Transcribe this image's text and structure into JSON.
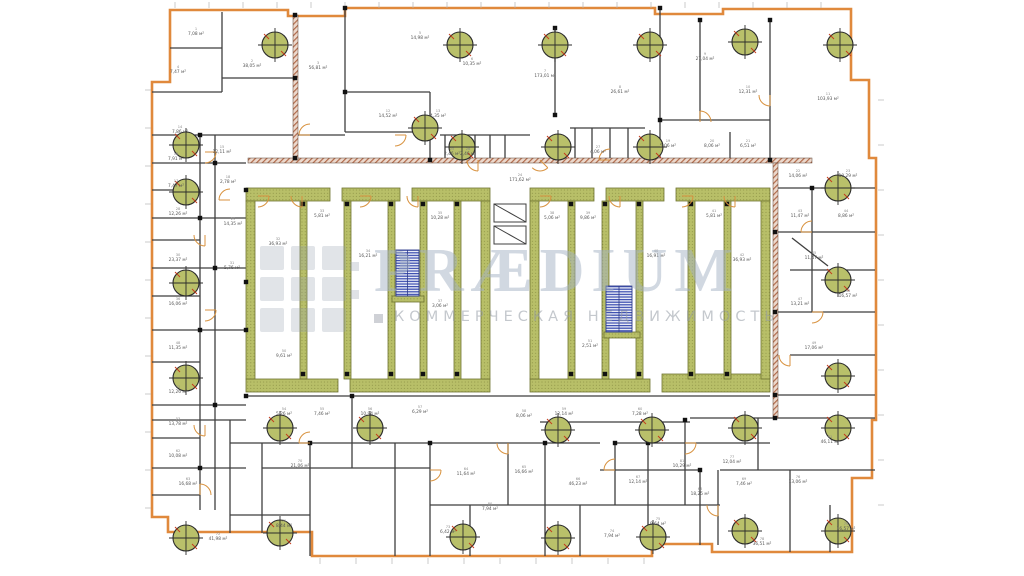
{
  "watermark": {
    "brand": "PRÆDIUM",
    "tagline": "КОММЕРЧЕСКАЯ НЕДВИЖИМОСТЬ"
  },
  "units": {
    "area": "м²"
  },
  "colors": {
    "exterior_wall": "#E0893C",
    "interior_wall": "#3F3F3F",
    "core_wall": "#B8BF68",
    "core_wall_edge": "#6F7430",
    "stair_hatch": "#3C4EB0",
    "column_marker": "#B9C06A",
    "door_arc": "#D8923F",
    "watermark_text": "#A8B2C4"
  },
  "symbols": {
    "column_marker": "circle-with-cross",
    "staircase": "navy-hatched-rect",
    "door": "quarter-arc",
    "brick_wall": "diagonal-hatch-band"
  },
  "rooms": [
    {
      "n": "1",
      "a": "7,08",
      "x": 196,
      "y": 30
    },
    {
      "n": "2",
      "a": "38,05",
      "x": 252,
      "y": 62
    },
    {
      "n": "3",
      "a": "56,81",
      "x": 318,
      "y": 64
    },
    {
      "n": "4",
      "a": "7,47",
      "x": 178,
      "y": 68
    },
    {
      "n": "5",
      "a": "14,98",
      "x": 420,
      "y": 34
    },
    {
      "n": "6",
      "a": "10,35",
      "x": 472,
      "y": 60
    },
    {
      "n": "7",
      "a": "173,01",
      "x": 545,
      "y": 72
    },
    {
      "n": "8",
      "a": "26,61",
      "x": 620,
      "y": 88
    },
    {
      "n": "9",
      "a": "27,04",
      "x": 705,
      "y": 55
    },
    {
      "n": "10",
      "a": "12,31",
      "x": 748,
      "y": 88
    },
    {
      "n": "11",
      "a": "103,93",
      "x": 828,
      "y": 95
    },
    {
      "n": "12",
      "a": "14,52",
      "x": 388,
      "y": 112
    },
    {
      "n": "13",
      "a": "4,35",
      "x": 438,
      "y": 112
    },
    {
      "n": "14",
      "a": "7,86",
      "x": 180,
      "y": 128
    },
    {
      "n": "15",
      "a": "12,11",
      "x": 222,
      "y": 148
    },
    {
      "n": "16",
      "a": "7,91",
      "x": 176,
      "y": 155
    },
    {
      "n": "17",
      "a": "7,47",
      "x": 176,
      "y": 182
    },
    {
      "n": "18",
      "a": "2,78",
      "x": 228,
      "y": 178
    },
    {
      "n": "19",
      "a": "5,06",
      "x": 668,
      "y": 142
    },
    {
      "n": "20",
      "a": "8,06",
      "x": 712,
      "y": 142
    },
    {
      "n": "21",
      "a": "6,51",
      "x": 748,
      "y": 142
    },
    {
      "n": "22",
      "a": "14,06",
      "x": 798,
      "y": 172
    },
    {
      "n": "23",
      "a": "10,29",
      "x": 848,
      "y": 172
    },
    {
      "n": "24",
      "a": "171,62",
      "x": 520,
      "y": 176
    },
    {
      "n": "25",
      "a": "2,46",
      "x": 452,
      "y": 150
    },
    {
      "n": "26",
      "a": "2,46",
      "x": 468,
      "y": 150
    },
    {
      "n": "27",
      "a": "4,06",
      "x": 598,
      "y": 148
    },
    {
      "n": "28",
      "a": "12,26",
      "x": 178,
      "y": 210
    },
    {
      "n": "29",
      "a": "14,35",
      "x": 233,
      "y": 220
    },
    {
      "n": "30",
      "a": "23,37",
      "x": 178,
      "y": 256
    },
    {
      "n": "31",
      "a": "5,76",
      "x": 232,
      "y": 264
    },
    {
      "n": "32",
      "a": "36,93",
      "x": 278,
      "y": 240
    },
    {
      "n": "33",
      "a": "5,81",
      "x": 322,
      "y": 212
    },
    {
      "n": "34",
      "a": "16,21",
      "x": 368,
      "y": 252
    },
    {
      "n": "35",
      "a": "10,28",
      "x": 440,
      "y": 214
    },
    {
      "n": "36",
      "a": "16,06",
      "x": 178,
      "y": 300
    },
    {
      "n": "37",
      "a": "3,06",
      "x": 440,
      "y": 302
    },
    {
      "n": "38",
      "a": "5,06",
      "x": 552,
      "y": 214
    },
    {
      "n": "39",
      "a": "9,86",
      "x": 588,
      "y": 214
    },
    {
      "n": "40",
      "a": "16,91",
      "x": 656,
      "y": 252
    },
    {
      "n": "41",
      "a": "5,81",
      "x": 714,
      "y": 212
    },
    {
      "n": "42",
      "a": "36,93",
      "x": 742,
      "y": 256
    },
    {
      "n": "43",
      "a": "11,47",
      "x": 800,
      "y": 212
    },
    {
      "n": "44",
      "a": "8,86",
      "x": 846,
      "y": 212
    },
    {
      "n": "45",
      "a": "11,47",
      "x": 814,
      "y": 254
    },
    {
      "n": "46",
      "a": "16,57",
      "x": 848,
      "y": 292
    },
    {
      "n": "47",
      "a": "13,21",
      "x": 800,
      "y": 300
    },
    {
      "n": "48",
      "a": "11,35",
      "x": 178,
      "y": 344
    },
    {
      "n": "49",
      "a": "17,06",
      "x": 814,
      "y": 344
    },
    {
      "n": "50",
      "a": "9,61",
      "x": 284,
      "y": 352
    },
    {
      "n": "51",
      "a": "2,51",
      "x": 590,
      "y": 342
    },
    {
      "n": "52",
      "a": "12,26",
      "x": 178,
      "y": 388
    },
    {
      "n": "53",
      "a": "13,78",
      "x": 178,
      "y": 420
    },
    {
      "n": "54",
      "a": "5,26",
      "x": 284,
      "y": 410
    },
    {
      "n": "55",
      "a": "7,46",
      "x": 322,
      "y": 410
    },
    {
      "n": "56",
      "a": "10,94",
      "x": 370,
      "y": 410
    },
    {
      "n": "57",
      "a": "6,29",
      "x": 420,
      "y": 408
    },
    {
      "n": "58",
      "a": "8,06",
      "x": 524,
      "y": 412
    },
    {
      "n": "59",
      "a": "12,14",
      "x": 564,
      "y": 410
    },
    {
      "n": "60",
      "a": "7,28",
      "x": 640,
      "y": 410
    },
    {
      "n": "61",
      "a": "46,11",
      "x": 830,
      "y": 438
    },
    {
      "n": "62",
      "a": "10,08",
      "x": 178,
      "y": 452
    },
    {
      "n": "63",
      "a": "16,68",
      "x": 188,
      "y": 480
    },
    {
      "n": "64",
      "a": "11,64",
      "x": 466,
      "y": 470
    },
    {
      "n": "65",
      "a": "16,66",
      "x": 524,
      "y": 468
    },
    {
      "n": "66",
      "a": "46,23",
      "x": 578,
      "y": 480
    },
    {
      "n": "67",
      "a": "12,14",
      "x": 638,
      "y": 478
    },
    {
      "n": "68",
      "a": "18,25",
      "x": 700,
      "y": 490
    },
    {
      "n": "69",
      "a": "7,46",
      "x": 744,
      "y": 480
    },
    {
      "n": "70",
      "a": "21,06",
      "x": 300,
      "y": 462
    },
    {
      "n": "71",
      "a": "8,44",
      "x": 284,
      "y": 522
    },
    {
      "n": "72",
      "a": "41,98",
      "x": 218,
      "y": 535
    },
    {
      "n": "73",
      "a": "6,42",
      "x": 448,
      "y": 528
    },
    {
      "n": "74",
      "a": "7,94",
      "x": 612,
      "y": 532
    },
    {
      "n": "75",
      "a": "9,64",
      "x": 658,
      "y": 520
    },
    {
      "n": "76",
      "a": "13,06",
      "x": 798,
      "y": 478
    },
    {
      "n": "77",
      "a": "12,04",
      "x": 732,
      "y": 458
    },
    {
      "n": "78",
      "a": "36,51",
      "x": 762,
      "y": 540
    },
    {
      "n": "79",
      "a": "16,57",
      "x": 846,
      "y": 525
    },
    {
      "n": "80",
      "a": "7,94",
      "x": 490,
      "y": 505
    },
    {
      "n": "81",
      "a": "10,29",
      "x": 682,
      "y": 462
    }
  ]
}
